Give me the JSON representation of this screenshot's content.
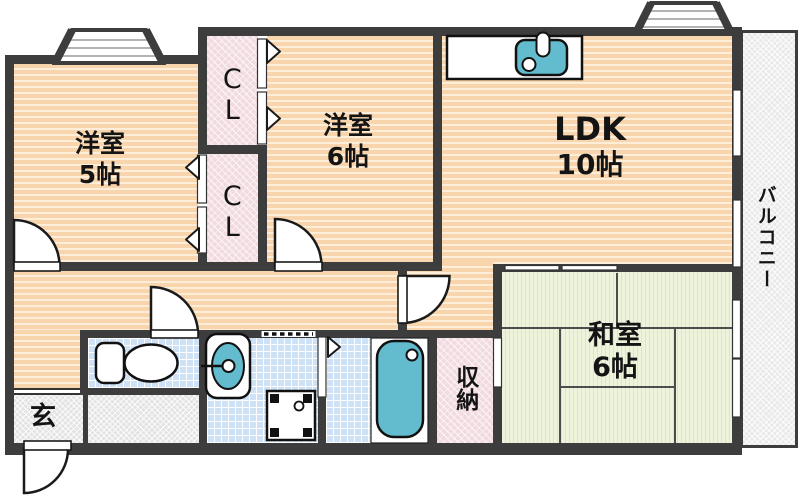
{
  "rooms": {
    "west5": {
      "name": "洋室",
      "size": "5帖"
    },
    "west6": {
      "name": "洋室",
      "size": "6帖"
    },
    "ldk": {
      "name": "LDK",
      "size": "10帖"
    },
    "washitsu": {
      "name": "和室",
      "size": "6帖"
    },
    "closet_upper": {
      "label": "CL"
    },
    "closet_lower": {
      "label": "CL"
    },
    "storage": {
      "label": "収納"
    },
    "entrance": {
      "label": "玄"
    },
    "balcony": {
      "label": "バルコニー"
    }
  },
  "fixtures": {
    "kitchen_sink": "kitchen-sink-icon",
    "toilet": "toilet-icon",
    "washbasin": "washbasin-icon",
    "washing_machine": "washing-machine-icon",
    "bathtub": "bathtub-icon"
  },
  "colors": {
    "wall": "#3d3d3d",
    "room_floor": "#f8d5ac",
    "tatami": "#eef3dc",
    "wet_area": "#cfe1f5",
    "closet": "#f2dbe0",
    "entrance_floor": "#e3e3e3",
    "fixture_teal": "#63bccd"
  }
}
